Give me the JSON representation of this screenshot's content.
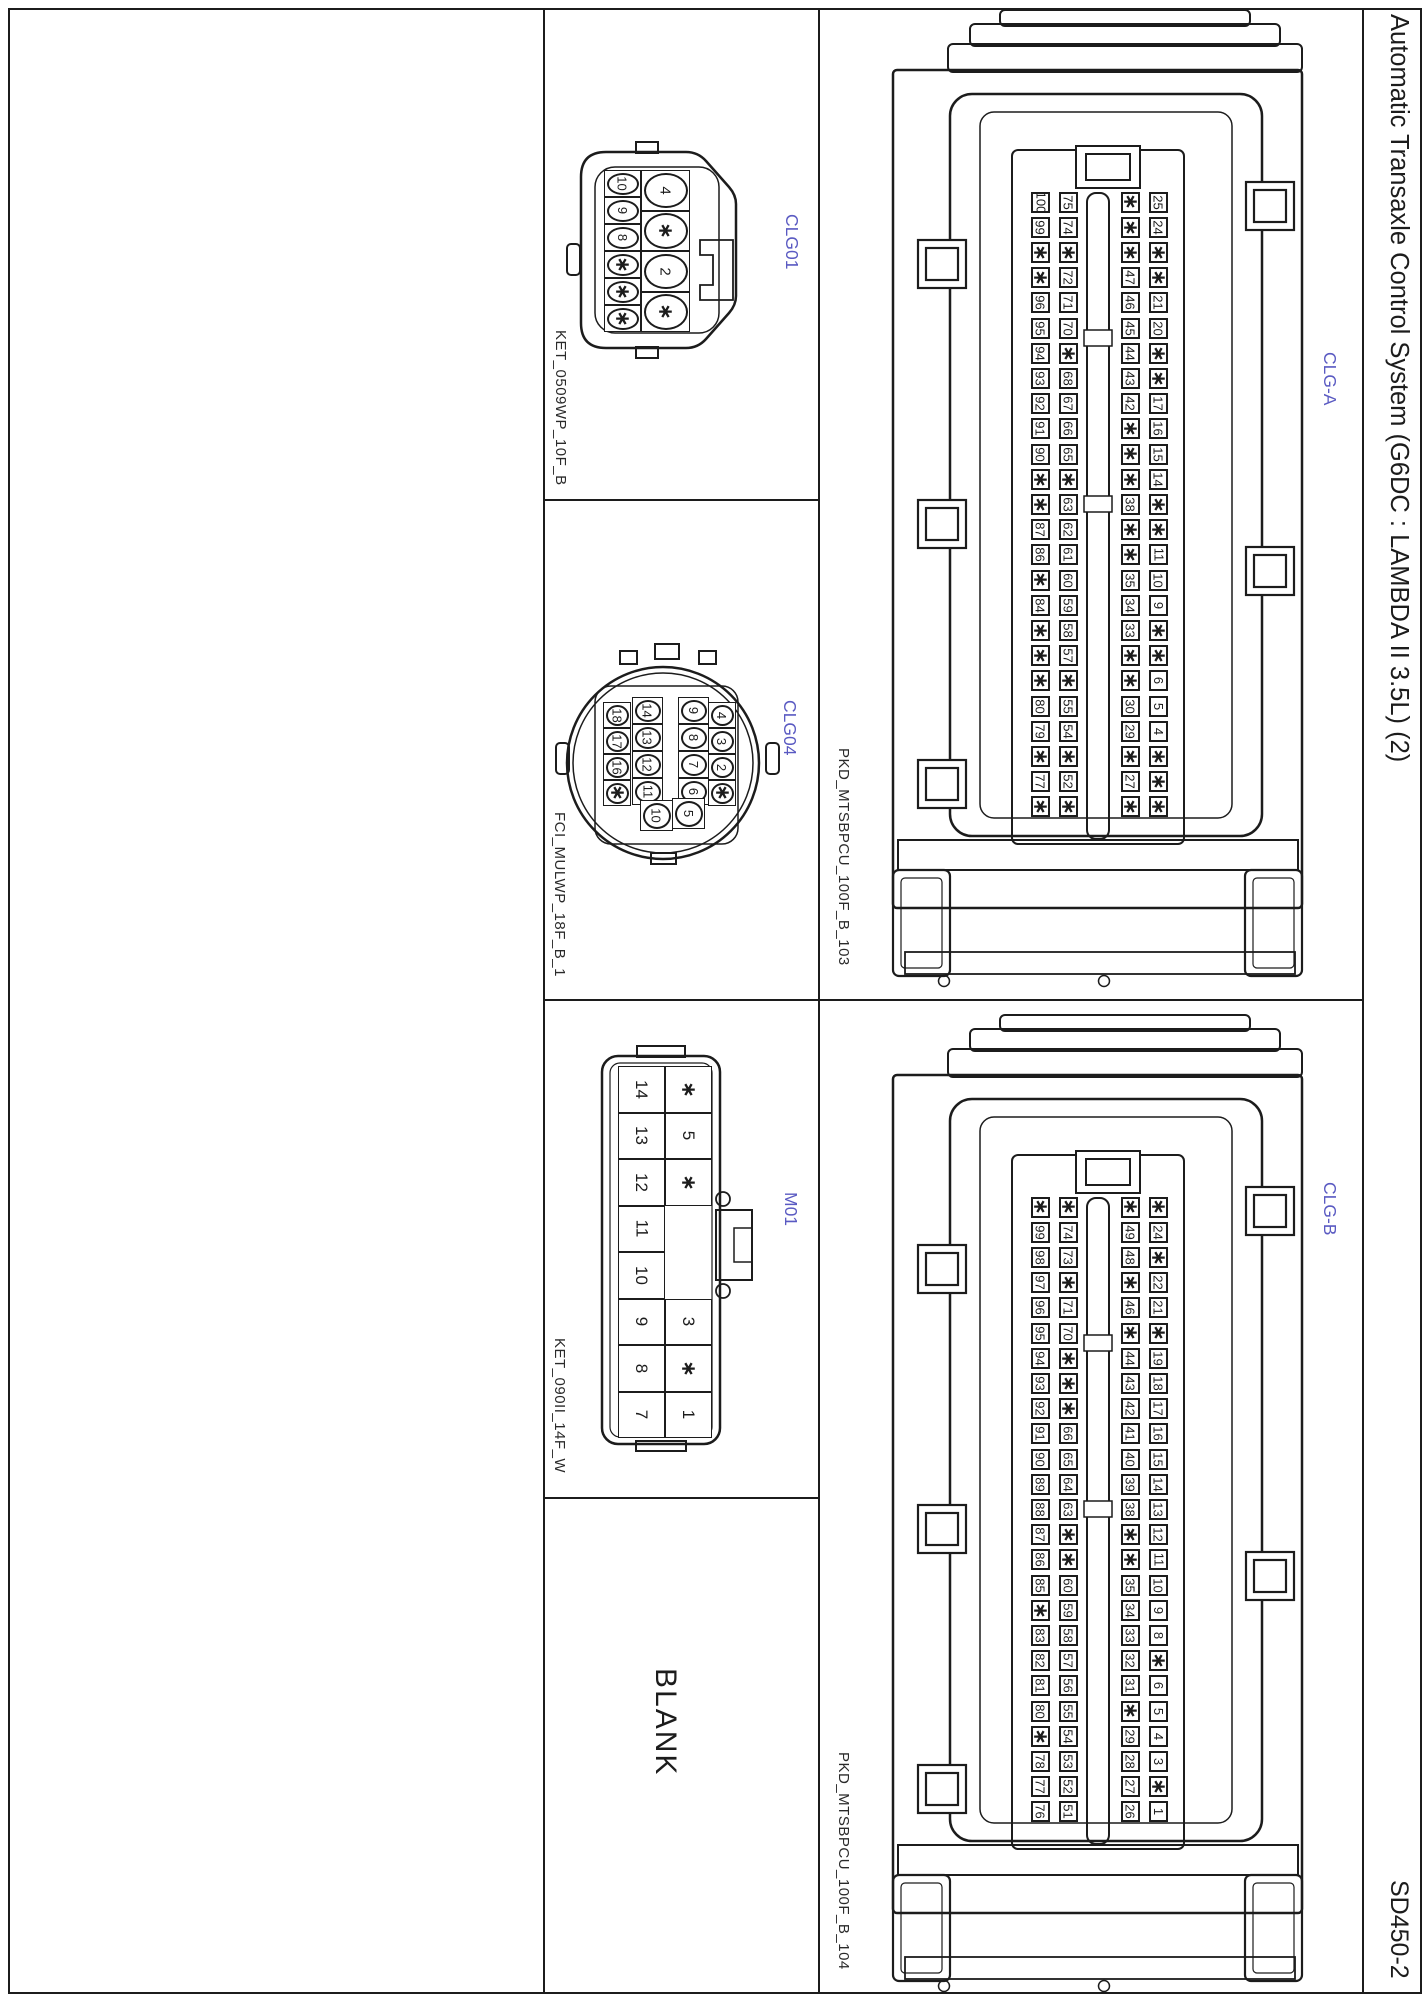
{
  "page": {
    "title": "Automatic Transaxle Control System (G6DC : LAMBDA II 3.5L) (2)",
    "doc_code": "SD450-2",
    "blank_label": "BLANK",
    "accent_color": "#5a5ac2",
    "line_color": "#1c1c1c"
  },
  "connectors": {
    "clg01": {
      "label": "CLG01",
      "part_number": "KET_0509WP_10F_B",
      "small_column_pins": [
        "10",
        "9",
        "8",
        "*",
        "*",
        "*"
      ],
      "large_column_pins": [
        "4",
        "*",
        "2",
        "*"
      ]
    },
    "clg04": {
      "label": "CLG04",
      "part_number": "FCI_MULWP_18F_B_1",
      "columns": [
        [
          "18",
          "17",
          "16",
          "*"
        ],
        [
          "14",
          "13",
          "12",
          "11",
          "10"
        ],
        [
          "9",
          "8",
          "7",
          "6",
          "5"
        ],
        [
          "4",
          "3",
          "2",
          "*"
        ]
      ]
    },
    "m01": {
      "label": "M01",
      "part_number": "KET_090II_14F_W",
      "left_column_pins": [
        "14",
        "13",
        "12",
        "11",
        "10",
        "9",
        "8",
        "7"
      ],
      "right_column_top_pins": [
        "*",
        "5",
        "*"
      ],
      "right_column_bottom_pins": [
        "3",
        "*",
        "1"
      ]
    },
    "clg_a": {
      "label": "CLG-A",
      "part_number": "PKD_MTSBPCU_100F_B_103",
      "pin_rows": [
        [
          "100",
          "75",
          "*",
          "25"
        ],
        [
          "99",
          "74",
          "*",
          "24"
        ],
        [
          "*",
          "*",
          "*",
          "*"
        ],
        [
          "*",
          "72",
          "47",
          "*"
        ],
        [
          "96",
          "71",
          "46",
          "21"
        ],
        [
          "95",
          "70",
          "45",
          "20"
        ],
        [
          "94",
          "*",
          "44",
          "*"
        ],
        [
          "93",
          "68",
          "43",
          "*"
        ],
        [
          "92",
          "67",
          "42",
          "17"
        ],
        [
          "91",
          "66",
          "*",
          "16"
        ],
        [
          "90",
          "65",
          "*",
          "15"
        ],
        [
          "*",
          "*",
          "*",
          "14"
        ],
        [
          "*",
          "63",
          "38",
          "*"
        ],
        [
          "87",
          "62",
          "*",
          "*"
        ],
        [
          "86",
          "61",
          "*",
          "11"
        ],
        [
          "*",
          "60",
          "35",
          "10"
        ],
        [
          "84",
          "59",
          "34",
          "9"
        ],
        [
          "*",
          "58",
          "33",
          "*"
        ],
        [
          "*",
          "57",
          "*",
          "*"
        ],
        [
          "*",
          "*",
          "*",
          "6"
        ],
        [
          "80",
          "55",
          "30",
          "5"
        ],
        [
          "79",
          "54",
          "29",
          "4"
        ],
        [
          "*",
          "*",
          "*",
          "*"
        ],
        [
          "77",
          "52",
          "27",
          "*"
        ],
        [
          "*",
          "*",
          "*",
          "*"
        ]
      ]
    },
    "clg_b": {
      "label": "CLG-B",
      "part_number": "PKD_MTSBPCU_100F_B_104",
      "pin_rows": [
        [
          "*",
          "*",
          "*",
          "*"
        ],
        [
          "99",
          "74",
          "49",
          "24"
        ],
        [
          "98",
          "73",
          "48",
          "*"
        ],
        [
          "97",
          "*",
          "*",
          "22"
        ],
        [
          "96",
          "71",
          "46",
          "21"
        ],
        [
          "95",
          "70",
          "*",
          "*"
        ],
        [
          "94",
          "*",
          "44",
          "19"
        ],
        [
          "93",
          "*",
          "43",
          "18"
        ],
        [
          "92",
          "*",
          "42",
          "17"
        ],
        [
          "91",
          "66",
          "41",
          "16"
        ],
        [
          "90",
          "65",
          "40",
          "15"
        ],
        [
          "89",
          "64",
          "39",
          "14"
        ],
        [
          "88",
          "63",
          "38",
          "13"
        ],
        [
          "87",
          "*",
          "*",
          "12"
        ],
        [
          "86",
          "*",
          "*",
          "11"
        ],
        [
          "85",
          "60",
          "35",
          "10"
        ],
        [
          "*",
          "59",
          "34",
          "9"
        ],
        [
          "83",
          "58",
          "33",
          "8"
        ],
        [
          "82",
          "57",
          "32",
          "*"
        ],
        [
          "81",
          "56",
          "31",
          "6"
        ],
        [
          "80",
          "55",
          "*",
          "5"
        ],
        [
          "*",
          "54",
          "29",
          "4"
        ],
        [
          "78",
          "53",
          "28",
          "3"
        ],
        [
          "77",
          "52",
          "27",
          "*"
        ],
        [
          "76",
          "51",
          "26",
          "1"
        ]
      ]
    }
  }
}
